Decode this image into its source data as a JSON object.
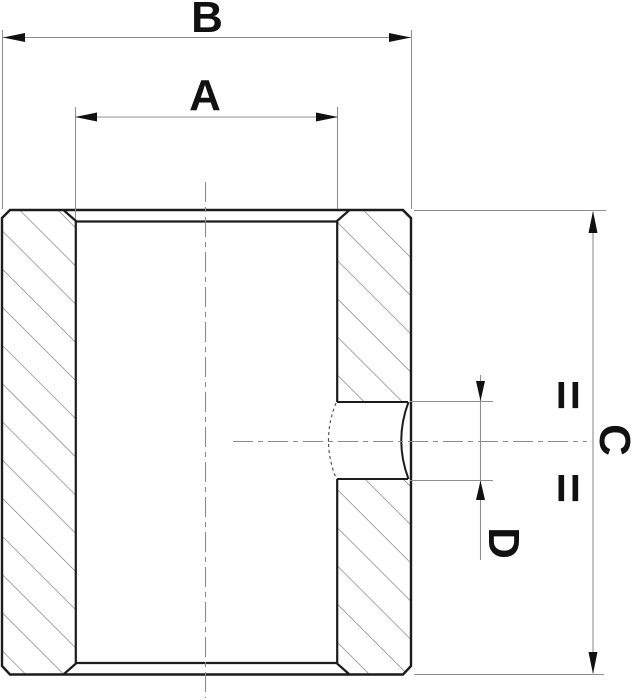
{
  "drawing": {
    "labels": {
      "dim_b": "B",
      "dim_a": "A",
      "dim_c": "C",
      "dim_d": "D"
    },
    "equality_symbol": "=",
    "colors": {
      "background": "#ffffff",
      "outline": "#1c1c1c",
      "thin_line": "#8f8f8f",
      "centerline": "#8a8a8a",
      "hatch": "#787878",
      "hidden_line": "#555555",
      "arrow": "#111111",
      "text": "#111111"
    }
  }
}
